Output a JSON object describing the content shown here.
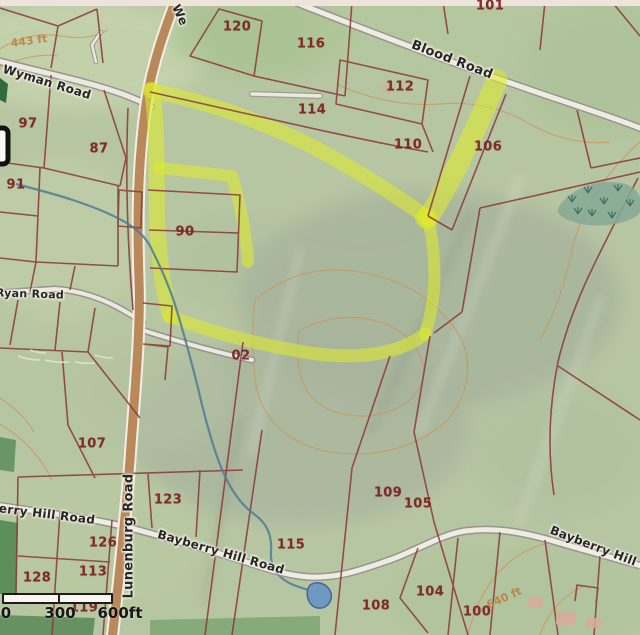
{
  "map": {
    "kind": "tax parcel map photograph with highlighted parcel",
    "parcels": [
      {
        "num": "120"
      },
      {
        "num": "116"
      },
      {
        "num": "101"
      },
      {
        "num": "112"
      },
      {
        "num": "114"
      },
      {
        "num": "110"
      },
      {
        "num": "106"
      },
      {
        "num": "97"
      },
      {
        "num": "87"
      },
      {
        "num": "91"
      },
      {
        "num": "90"
      },
      {
        "num": "02"
      },
      {
        "num": "107"
      },
      {
        "num": "123"
      },
      {
        "num": "126"
      },
      {
        "num": "128"
      },
      {
        "num": "113"
      },
      {
        "num": "119"
      },
      {
        "num": "115"
      },
      {
        "num": "109"
      },
      {
        "num": "105"
      },
      {
        "num": "104"
      },
      {
        "num": "108"
      },
      {
        "num": "100"
      }
    ],
    "roads": {
      "wyman": "Wyman Road",
      "blood": "Blood Road",
      "ryan": "Ryan Road",
      "bayberry_left": "Bayberry Hill Road",
      "bayberry_mid": "Bayberry Hill Road",
      "bayberry_right": "Bayberry Hill Road",
      "lunenburg": "Lunenburg Road",
      "top_partial": "We"
    },
    "contours": {
      "c443": "443 ft",
      "c640": "640 ft"
    },
    "scale_bar": {
      "start": "0",
      "mid": "300",
      "end": "600ft"
    },
    "colors": {
      "terrain": "#b7c6a2",
      "highlight": "#dcea2e",
      "parcel_line": "#8a3838",
      "parcel_label": "#7c2022",
      "road_tan": "#b9895c",
      "road_light": "#efece4",
      "stream": "#4e7d92",
      "pond": "#6f99c0",
      "contour": "#cf9355",
      "forest": "#5d8f5a"
    }
  }
}
